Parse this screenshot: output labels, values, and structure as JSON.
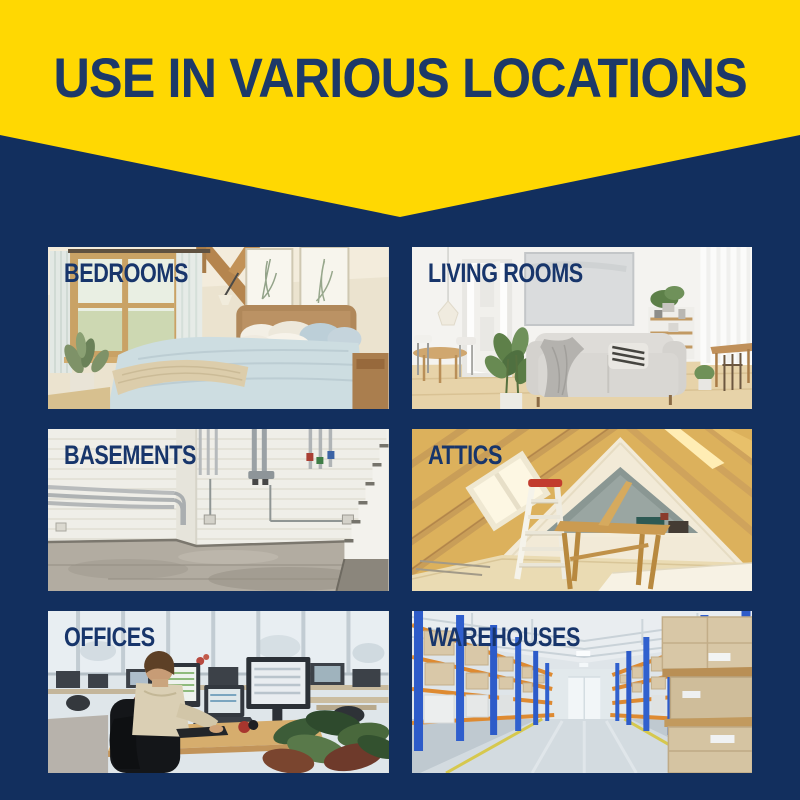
{
  "banner": {
    "title": "USE IN VARIOUS LOCATIONS"
  },
  "colors": {
    "banner_yellow": "#FFD802",
    "background_navy": "#122F5E",
    "heading_navy": "#1D3968",
    "label_navy": "#17356B"
  },
  "tiles": [
    {
      "label": "BEDROOMS",
      "photo": "bedrooms-photo"
    },
    {
      "label": "LIVING ROOMS",
      "photo": "living-rooms-photo"
    },
    {
      "label": "BASEMENTS",
      "photo": "basements-photo"
    },
    {
      "label": "ATTICS",
      "photo": "attics-photo"
    },
    {
      "label": "OFFICES",
      "photo": "offices-photo"
    },
    {
      "label": "WAREHOUSES",
      "photo": "warehouses-photo"
    }
  ]
}
